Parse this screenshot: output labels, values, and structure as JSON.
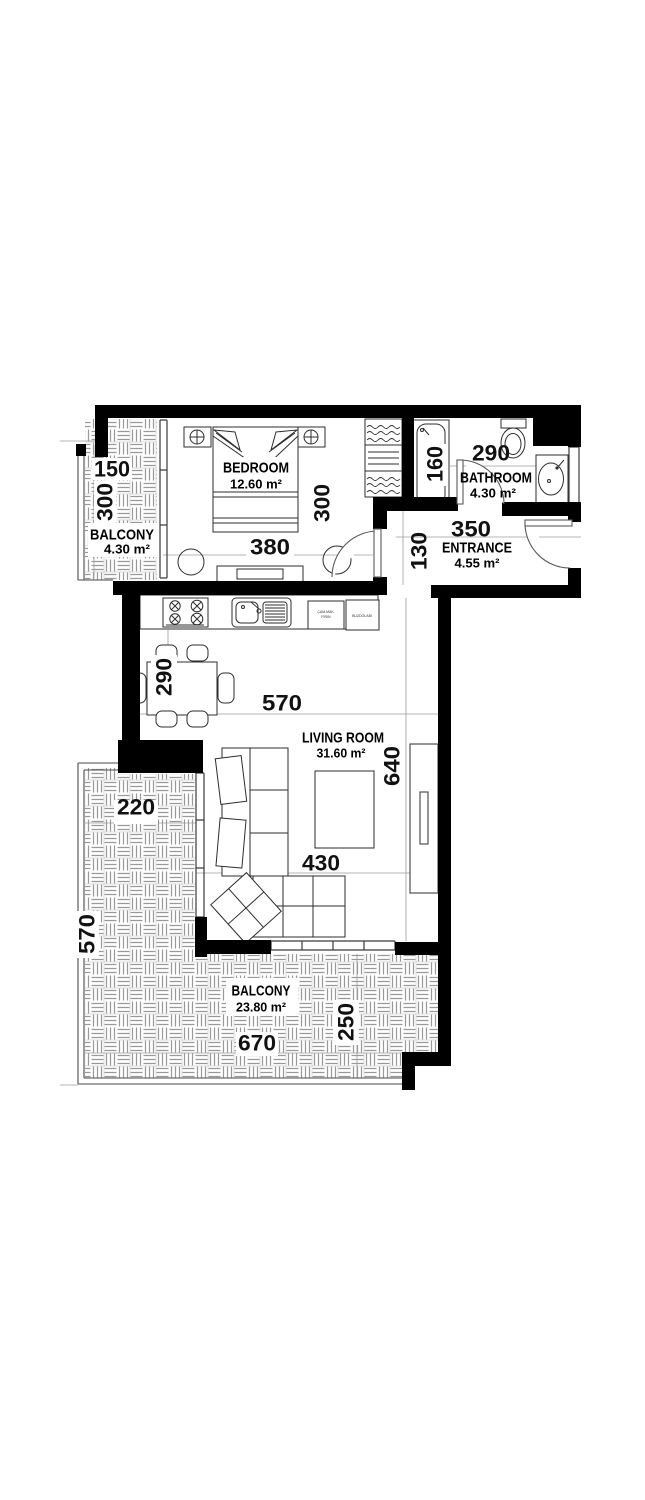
{
  "plan": {
    "rooms": {
      "balcony_top": {
        "label": "BALCONY",
        "area": "4.30 m²"
      },
      "bedroom": {
        "label": "BEDROOM",
        "area": "12.60 m²"
      },
      "bathroom": {
        "label": "BATHROOM",
        "area": "4.30 m²"
      },
      "entrance": {
        "label": "ENTRANCE",
        "area": "4.55 m²"
      },
      "living_room": {
        "label": "LIVING ROOM",
        "area": "31.60 m²"
      },
      "balcony_bottom": {
        "label": "BALCONY",
        "area": "23.80 m²"
      }
    },
    "dimensions_cm": {
      "balcony_top_width": "150",
      "balcony_top_depth": "300",
      "bedroom_width": "380",
      "bedroom_depth": "300",
      "bath_niche": "160",
      "bathroom_width": "290",
      "entrance_width": "350",
      "entrance_depth": "130",
      "dining_depth": "290",
      "living_width_top": "570",
      "living_depth": "640",
      "living_width_bottom": "430",
      "balcony_left_width": "220",
      "balcony_left_depth": "570",
      "balcony_bottom_width": "670",
      "balcony_bottom_depth": "250"
    },
    "kitchen": {
      "appliance_left_line1": "ÇAM.MAK.",
      "appliance_left_line2": "FIRIN",
      "appliance_right": "BUZDOLABI"
    },
    "colors": {
      "wall": "#000000",
      "paper": "#ffffff",
      "tile_line": "#999999"
    }
  }
}
